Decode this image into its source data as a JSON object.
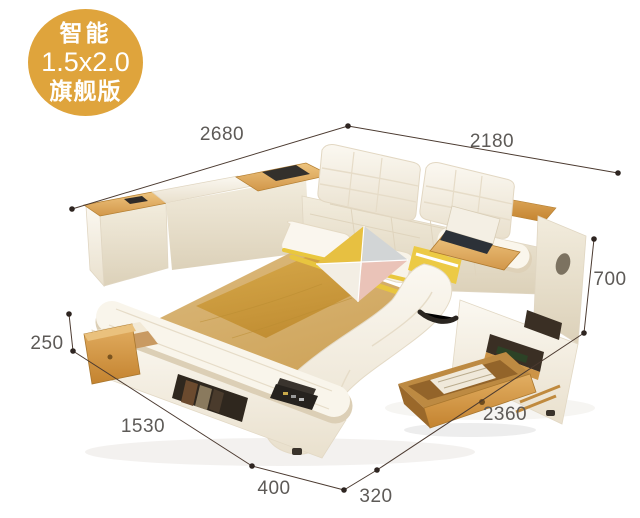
{
  "badge": {
    "line1": "智能",
    "line2": "1.5x2.0",
    "line3": "旗舰版"
  },
  "dimensions": {
    "top_left": "2680",
    "top_right": "2180",
    "right_height": "700",
    "left_drawer_height": "250",
    "bottom_left": "1530",
    "bottom_front_left": "400",
    "bottom_front_right": "320",
    "bottom_right": "2360"
  },
  "colors": {
    "badge_gold": "#dfa43c",
    "dimension_line": "#4b3a30",
    "dimension_text": "#5d5a57",
    "wood_accent": "#cf9242",
    "mattress_gold": "#c89a3e",
    "leather_cream": "#f6f1e6"
  }
}
